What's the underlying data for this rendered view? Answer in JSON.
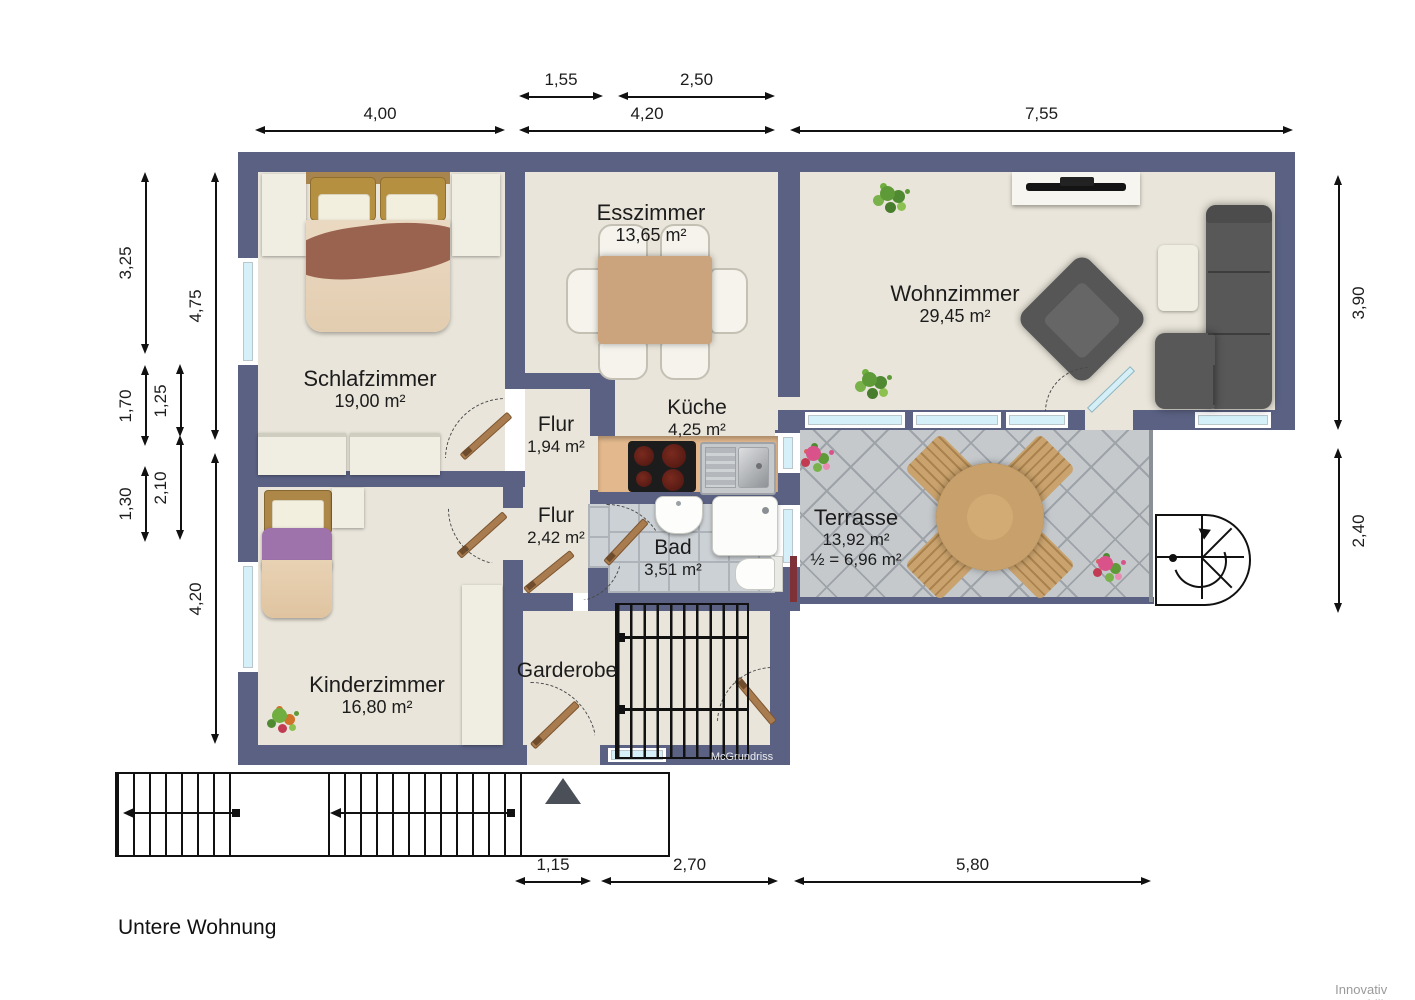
{
  "title": "Untere Wohnung",
  "branding": {
    "watermark": "McGrundriss",
    "credit": "Innovativ Immobilien"
  },
  "rooms": {
    "schlafzimmer": {
      "name": "Schlafzimmer",
      "area": "19,00 m²"
    },
    "esszimmer": {
      "name": "Esszimmer",
      "area": "13,65 m²"
    },
    "wohnzimmer": {
      "name": "Wohnzimmer",
      "area": "29,45 m²"
    },
    "kueche": {
      "name": "Küche",
      "area": "4,25 m²"
    },
    "flur_klein": {
      "name": "Flur",
      "area": "1,94 m²"
    },
    "flur_gross": {
      "name": "Flur",
      "area": "2,42 m²"
    },
    "bad": {
      "name": "Bad",
      "area": "3,51 m²"
    },
    "kinderzimmer": {
      "name": "Kinderzimmer",
      "area": "16,80 m²"
    },
    "garderobe": {
      "name": "Garderobe"
    },
    "terrasse": {
      "name": "Terrasse",
      "area": "13,92 m²",
      "area_half": "½ = 6,96 m²"
    }
  },
  "dimensions": {
    "top": [
      {
        "label": "1,55"
      },
      {
        "label": "2,50"
      },
      {
        "label": "4,00"
      },
      {
        "label": "4,20"
      },
      {
        "label": "7,55"
      }
    ],
    "left": [
      {
        "label": "3,25"
      },
      {
        "label": "1,70"
      },
      {
        "label": "1,30"
      },
      {
        "label": "1,25"
      },
      {
        "label": "2,10"
      },
      {
        "label": "4,75"
      },
      {
        "label": "4,20"
      }
    ],
    "right": [
      {
        "label": "3,90"
      },
      {
        "label": "2,40"
      }
    ],
    "bottom": [
      {
        "label": "1,15"
      },
      {
        "label": "2,70"
      },
      {
        "label": "5,80"
      }
    ]
  },
  "colors": {
    "wall": "#5a6183",
    "floor": "#e9e5da",
    "terrace_tile": "#c5c9cc",
    "window_glass": "#d5f0f8",
    "door_wood": "#a87c4e",
    "sofa": "#585858",
    "dining_table": "#cba47e",
    "kitchen_counter": "#e2b88c"
  }
}
